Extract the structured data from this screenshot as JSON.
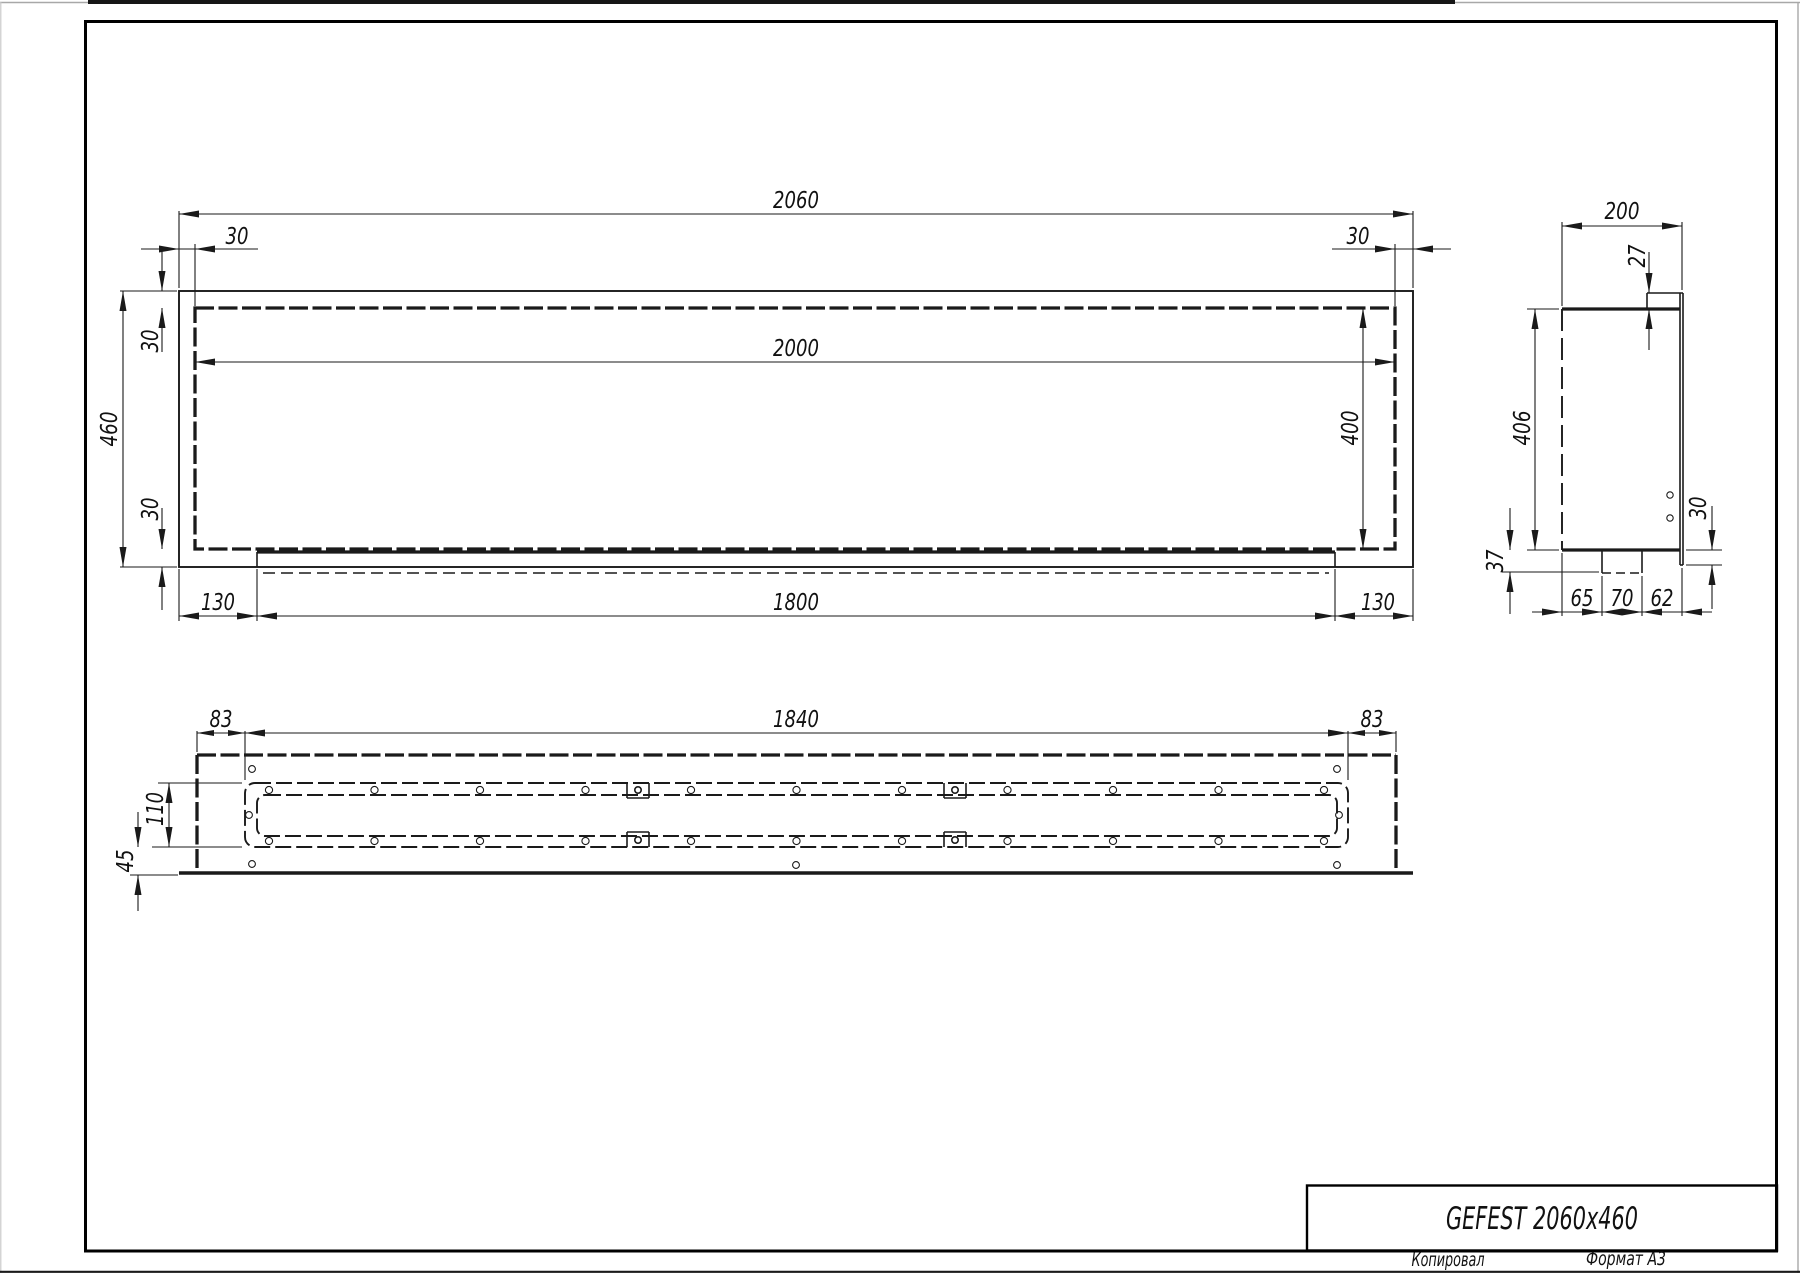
{
  "sheet": {
    "title": "GEFEST 2060x460",
    "copied_label": "Копировал",
    "format_label": "Формат А3"
  },
  "front_view": {
    "dim_overall_width": "2060",
    "dim_frame_top_left": "30",
    "dim_frame_top_right": "30",
    "dim_opening_width": "2000",
    "dim_overall_height": "460",
    "dim_frame_left_upper": "30",
    "dim_frame_left_lower": "30",
    "dim_opening_height": "400",
    "dim_bottom_left": "130",
    "dim_bottom_center": "1800",
    "dim_bottom_right": "130"
  },
  "side_view": {
    "dim_depth": "200",
    "dim_top_flange": "27",
    "dim_body_height": "406",
    "dim_tray_depth": "37",
    "dim_front_lip": "30",
    "dim_seg_left": "65",
    "dim_seg_center": "70",
    "dim_seg_right": "62"
  },
  "top_view": {
    "dim_margin_left": "83",
    "dim_slot_length": "1840",
    "dim_margin_right": "83",
    "dim_slot_width": "110",
    "dim_front_margin": "45"
  }
}
